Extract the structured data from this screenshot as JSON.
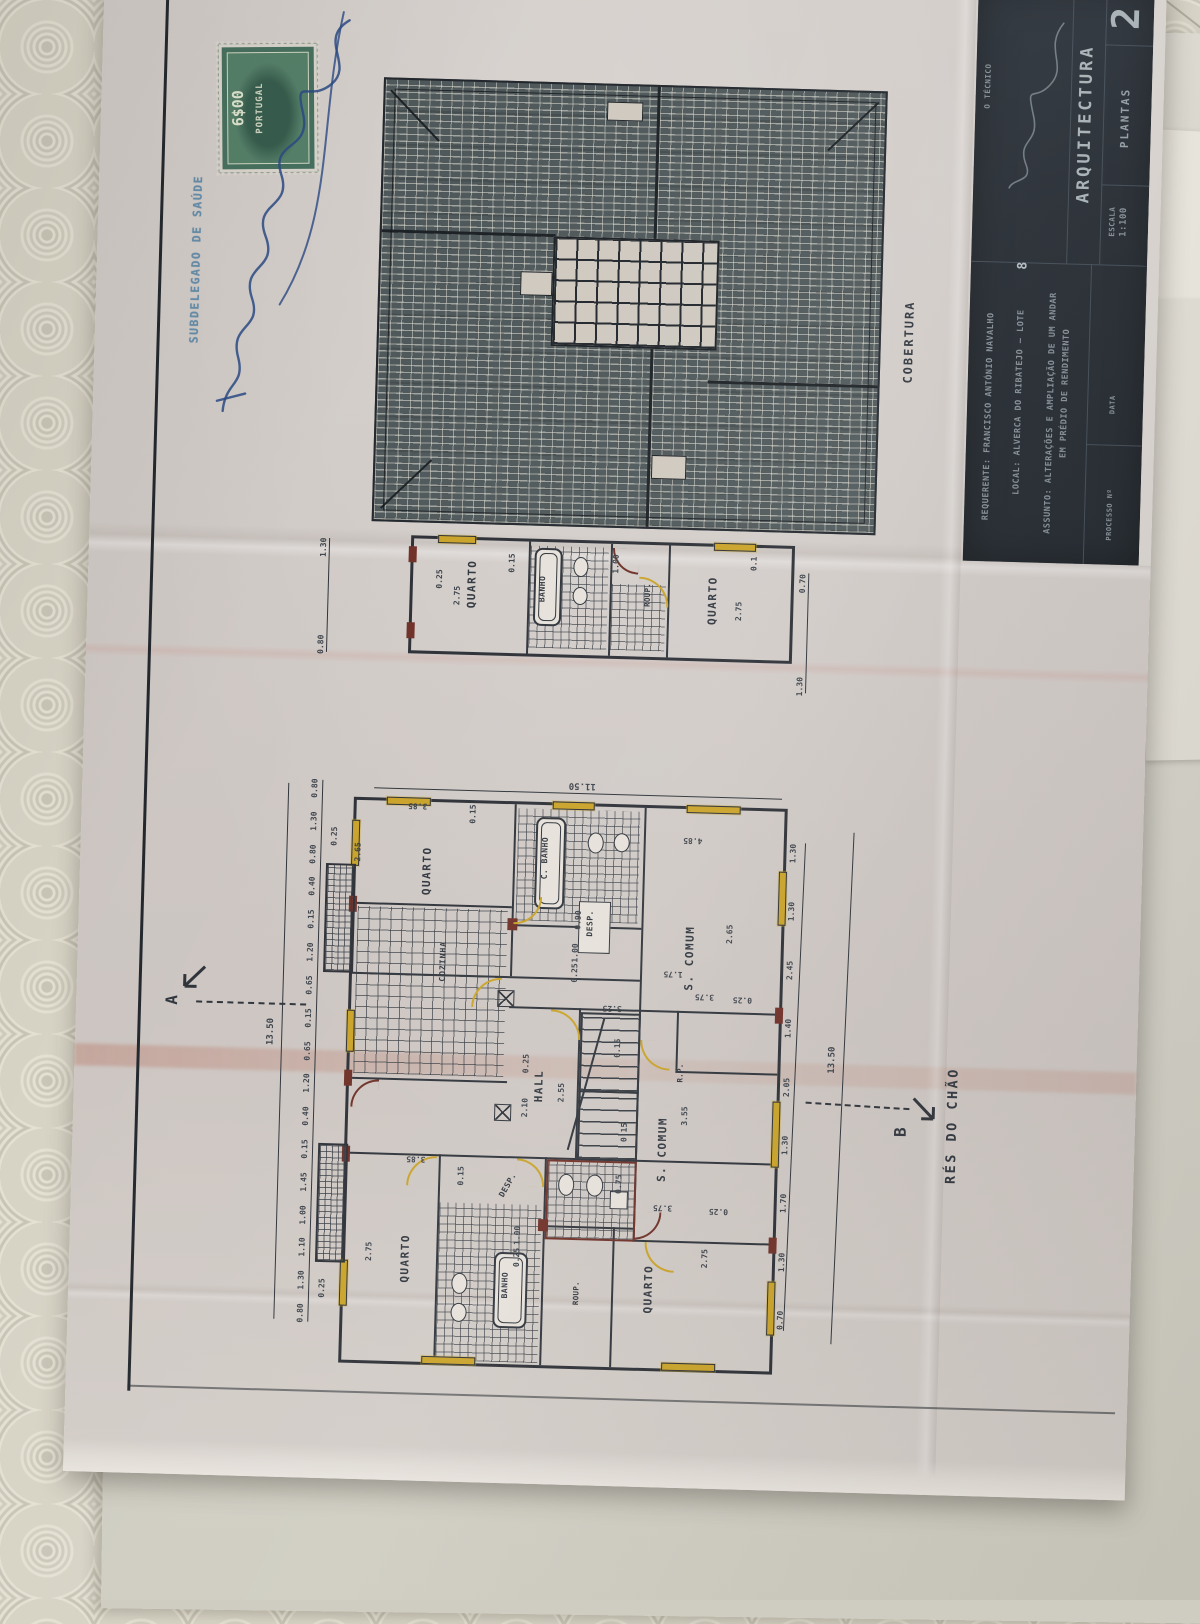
{
  "colors": {
    "paper": "#cfc9c4",
    "ink": "#2e333a",
    "highlight_yellow": "#c9a227",
    "accent_maroon": "#6e2f26",
    "titleblock_bg": "#262c33",
    "titleblock_text": "#97a1a7",
    "stamp_green": "#47705f",
    "official_stamp_blue": "#5b87a6",
    "signature_blue": "#2a4a85",
    "tablecloth": "#d7d3c5",
    "roof_fill": "#4f585a"
  },
  "stamps": {
    "revenue_value": "6$00",
    "revenue_country": "PORTUGAL",
    "official_text": "SUBDELEGADO DE SAÚDE"
  },
  "roof_plan": {
    "title": "COBERTURA"
  },
  "upper_plan": {
    "rooms": [
      "QUARTO",
      "BANHO",
      "ROUP.",
      "QUARTO"
    ],
    "chain_left": [
      "1.30",
      "0.80"
    ],
    "chain_right": [
      "0.70",
      "1.30"
    ],
    "dims_inner": [
      "0.25",
      "2.75",
      "0.15",
      "1.00",
      "2.75",
      "0.1"
    ]
  },
  "main_plan": {
    "floor_title": "RÉS DO CHÃO",
    "section_a": "A",
    "section_b": "B",
    "overall_top": "11.50",
    "overall_left": "13.50",
    "overall_right": "13.50",
    "rooms": [
      "QUARTO",
      "C. BANHO",
      "DESP.",
      "S. COMUM",
      "COZINHA",
      "HALL",
      "R.P.",
      "S. COMUM",
      "DESP.",
      "QUARTO",
      "BANHO",
      "ROUP.",
      "QUARTO"
    ],
    "chain_left": [
      "0.80",
      "1.30",
      "0.80",
      "0.40",
      "0.15",
      "1.20",
      "0.65",
      "0.15",
      "0.65",
      "1.20",
      "0.40",
      "0.15",
      "1.45",
      "1.00",
      "1.10",
      "1.30",
      "0.80"
    ],
    "chain_right": [
      "1.30",
      "1.30",
      "2.45",
      "1.40",
      "2.05",
      "1.30",
      "1.70",
      "1.30",
      "0.70"
    ],
    "dims_inner": [
      "0.25",
      "2.65",
      "3.85",
      "0.15",
      "0.90",
      "1.00",
      "0.25",
      "4.85",
      "2.65",
      "1.75",
      "3.75",
      "0.25",
      "3.25",
      "2.55",
      "2.10",
      "0.25",
      "0.15",
      "3.55",
      "3.75",
      "0.25",
      "2.75",
      "3.85",
      "0.15",
      "2.75",
      "0.25",
      "1.00",
      "0.25",
      "0.75",
      "0.15"
    ]
  },
  "title_block": {
    "sheet_number": "2",
    "tecnico_label": "O TÉCNICO",
    "discipline": "ARQUITECTURA",
    "drawing_type": "PLANTAS",
    "escala_label": "ESCALA",
    "escala_value": "1:100",
    "requerente_label": "REQUERENTE:",
    "requerente_value": "FRANCISCO ANTÓNIO NAVALHO",
    "local_label": "LOCAL:",
    "local_value": "ALVERCA DO RIBATEJO — LOTE",
    "lote_number": "8",
    "assunto_label": "ASSUNTO:",
    "assunto_line1": "ALTERAÇÕES E AMPLIAÇÃO DE UM ANDAR",
    "assunto_line2": "EM PRÉDIO DE RENDIMENTO",
    "processo_label": "PROCESSO Nº",
    "data_label": "DATA"
  }
}
